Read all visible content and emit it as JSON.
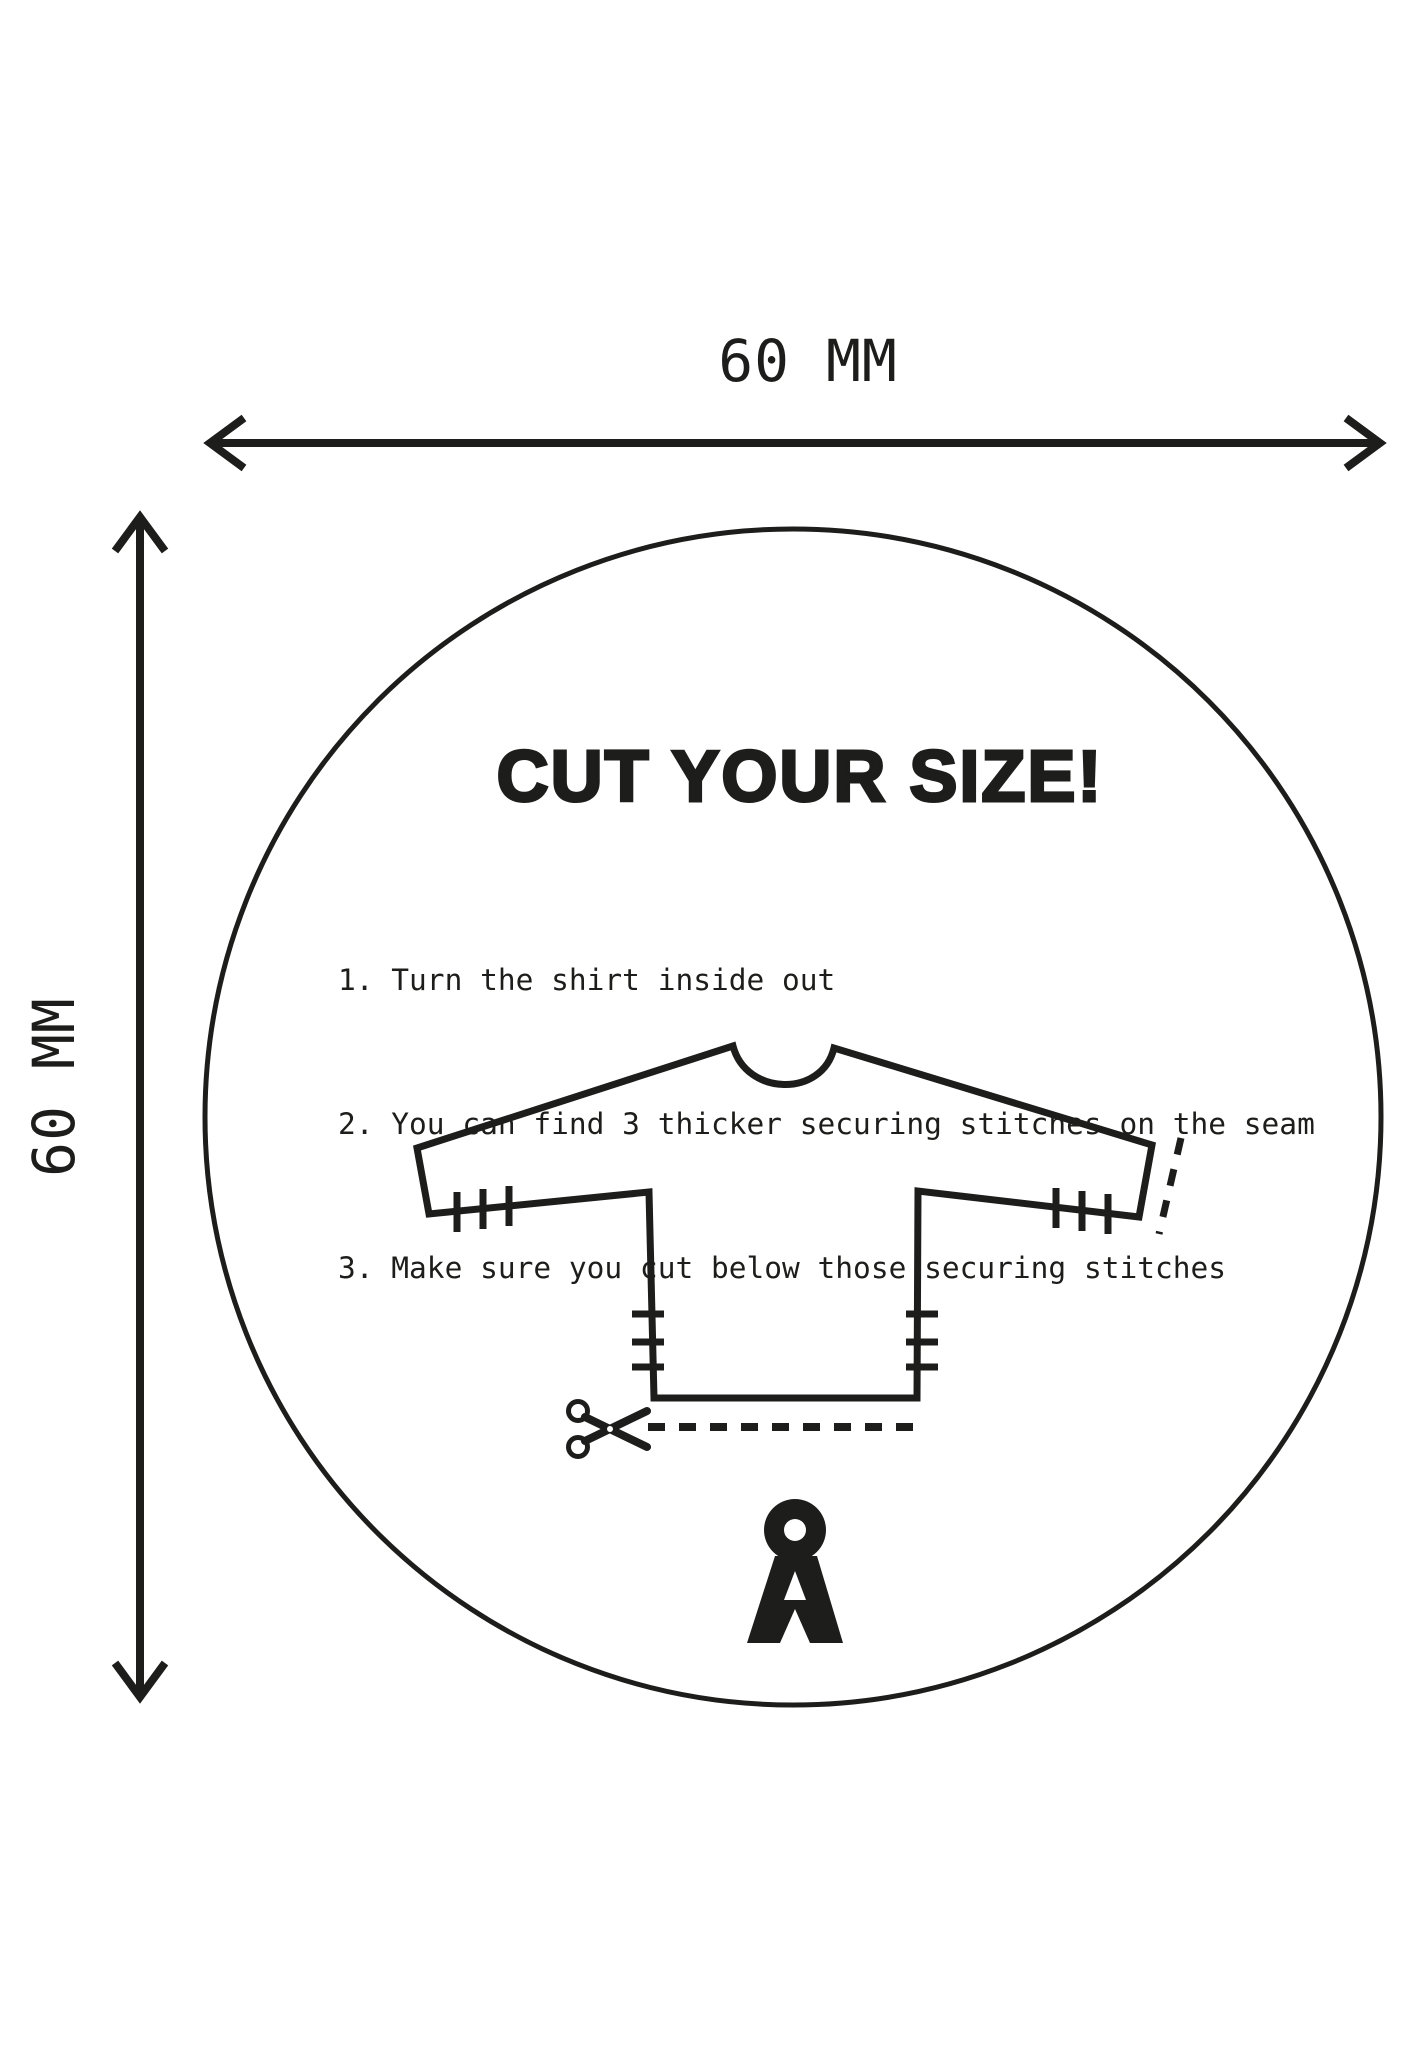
{
  "page": {
    "background": "#ffffff",
    "ink": "#1d1d1b"
  },
  "dimensions": {
    "top_label": "60 MM",
    "left_label": "60 MM"
  },
  "badge": {
    "title": "CUT YOUR SIZE!",
    "instructions": [
      "1. Turn the shirt inside out",
      "2. You can find 3 thicker securing stitches on the seam",
      "3. Make sure you cut below those securing stitches"
    ]
  },
  "icons": {
    "scissors": "scissors-icon",
    "brand_logo": "a-ring-brand-logo"
  }
}
